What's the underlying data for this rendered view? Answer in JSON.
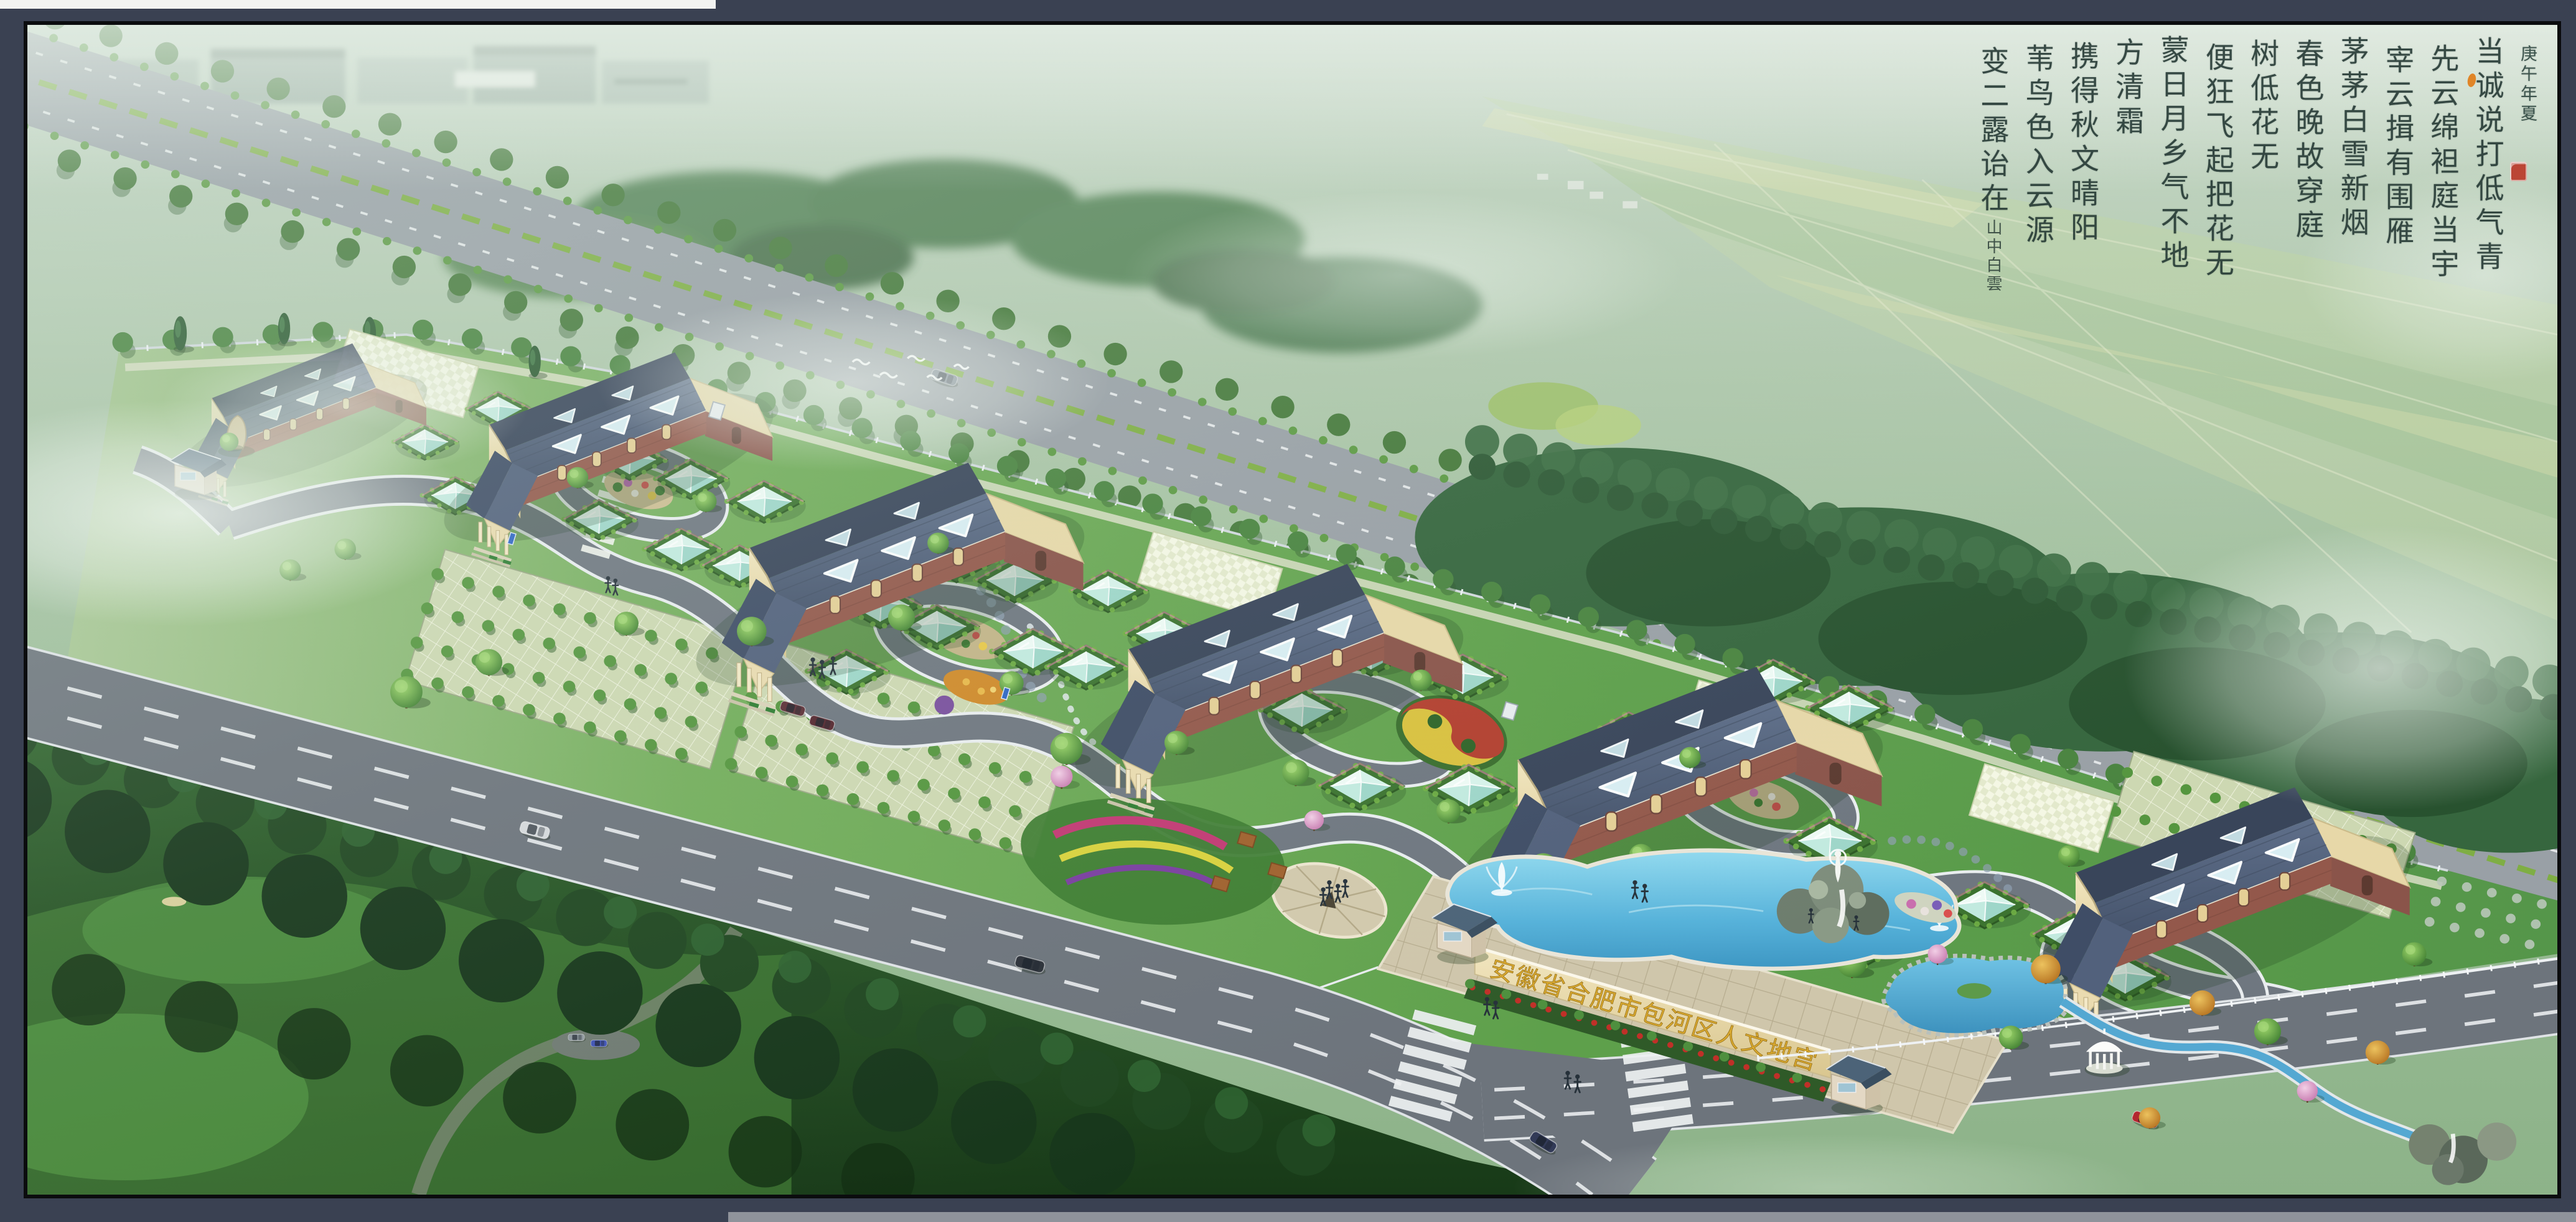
{
  "entrance": {
    "sign_text": "安徽省合肥市包河区人文地宫",
    "sign_color": "#d9a92f"
  },
  "calligraphy": {
    "date_inscription": "庚午年夏",
    "columns": [
      "当诚说打低气青",
      "先云绵袒庭当宇",
      "宰云揖有围雁",
      "茅茅白雪新烟",
      "春色晚故穿庭",
      "树低花无",
      "便狂飞起把花无",
      "蒙日月乡气不地",
      "方清霜",
      "携得秋文晴阳",
      "苇鸟色入云源",
      "变二露诒在"
    ],
    "signature": "山中白雲"
  },
  "palette": {
    "frame_slate": "#3a4152",
    "frame_black": "#0b0c0e",
    "haze_green": "#aec7ae",
    "lawn_green": "#69a84f",
    "forest_dark": "#2a5b2b",
    "road_gray": "#6d747c",
    "highway_gray": "#99a0a6",
    "pool_water": "#56b2da",
    "pond_water": "#4f9fc9",
    "roof_slate": "#46546c",
    "brick_red": "#95594b",
    "portico_cream": "#e9dcb2",
    "glass_pyramid": "#bfe9e0",
    "hedge_green": "#3c7330",
    "sign_gold": "#d9a92f",
    "blossom_pink": "#d68fc0",
    "autumn_orange": "#c8832e",
    "seal_red": "#bb3a2a"
  }
}
